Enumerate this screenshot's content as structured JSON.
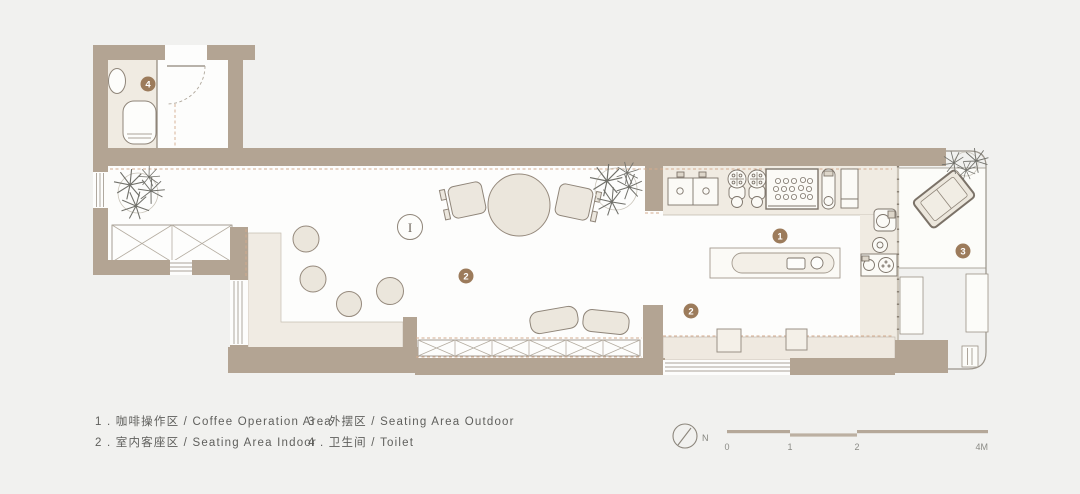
{
  "title": "cafe-floor-plan",
  "legend": {
    "items": [
      {
        "label": "1 . 咖啡操作区 / Coffee Operation Area"
      },
      {
        "label": "2 . 室内客座区 / Seating Area Indoor"
      },
      {
        "label": "3 . 外摆区 / Seating Area Outdoor"
      },
      {
        "label": "4 . 卫生间 / Toilet"
      }
    ]
  },
  "plan": {
    "badges": {
      "coffee_area": "1",
      "indoor_seating_a": "2",
      "indoor_seating_b": "2",
      "outdoor_area": "3",
      "toilet": "4"
    },
    "table_marker": "I"
  },
  "compass": {
    "north_label": "N"
  },
  "scale_bar": {
    "ticks": [
      "0",
      "1",
      "2",
      "4M"
    ]
  },
  "colors": {
    "background": "#f1f1ef",
    "wall": "#b3a493",
    "floor_white": "#fdfdfc",
    "floor_beige": "#f0ebe2",
    "furniture_fill": "#ebe6dc",
    "furniture_stroke": "#8f8579",
    "badge": "#9c7b5b",
    "dashed_finish_line": "#d4ab8e",
    "scale_bar": "#b5a899",
    "text": "#5f5f5c"
  }
}
